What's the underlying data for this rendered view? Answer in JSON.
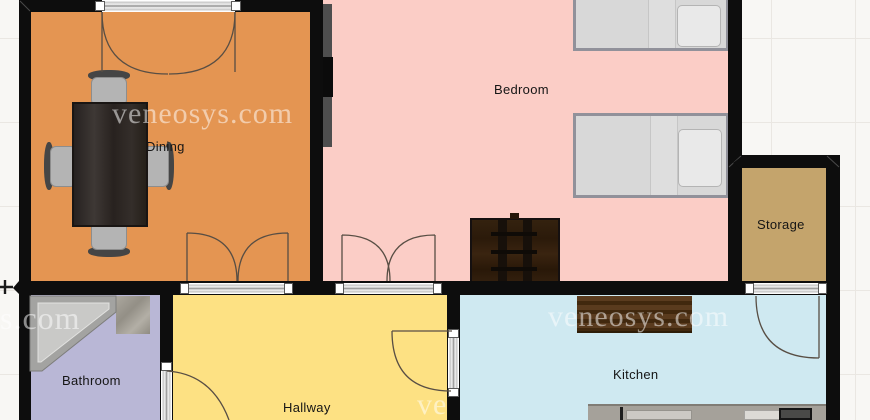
{
  "plan": {
    "type_label": "floor-plan",
    "watermark_full": "veneosys.com",
    "watermark_partial_left": "s.com",
    "watermark_partial_bottom": "ve"
  },
  "rooms": [
    {
      "id": "dining",
      "label": "Dining",
      "color": "#e49552"
    },
    {
      "id": "bedroom",
      "label": "Bedroom",
      "color": "#fbcdc6"
    },
    {
      "id": "storage",
      "label": "Storage",
      "color": "#c4a46c"
    },
    {
      "id": "bathroom",
      "label": "Bathroom",
      "color": "#b9b7d6"
    },
    {
      "id": "hallway",
      "label": "Hallway",
      "color": "#fde183"
    },
    {
      "id": "kitchen",
      "label": "Kitchen",
      "color": "#cfe9f1"
    }
  ],
  "palette": {
    "wall": "#0d0d0d",
    "background": "#f8f7f4",
    "grid_line": "#eae7e2",
    "door_line": "#584e44",
    "label_text": "#151515"
  },
  "furniture_icons": [
    "dining-table-icon",
    "dining-chair-icon",
    "tv-console-icon",
    "tv-icon",
    "single-bed-icon",
    "pillow-icon",
    "dresser-icon",
    "corner-bathtub-icon",
    "washbasin-icon",
    "kitchen-counter-icon",
    "kitchen-sink-icon",
    "stove-icon",
    "crosshair-marker-icon"
  ]
}
